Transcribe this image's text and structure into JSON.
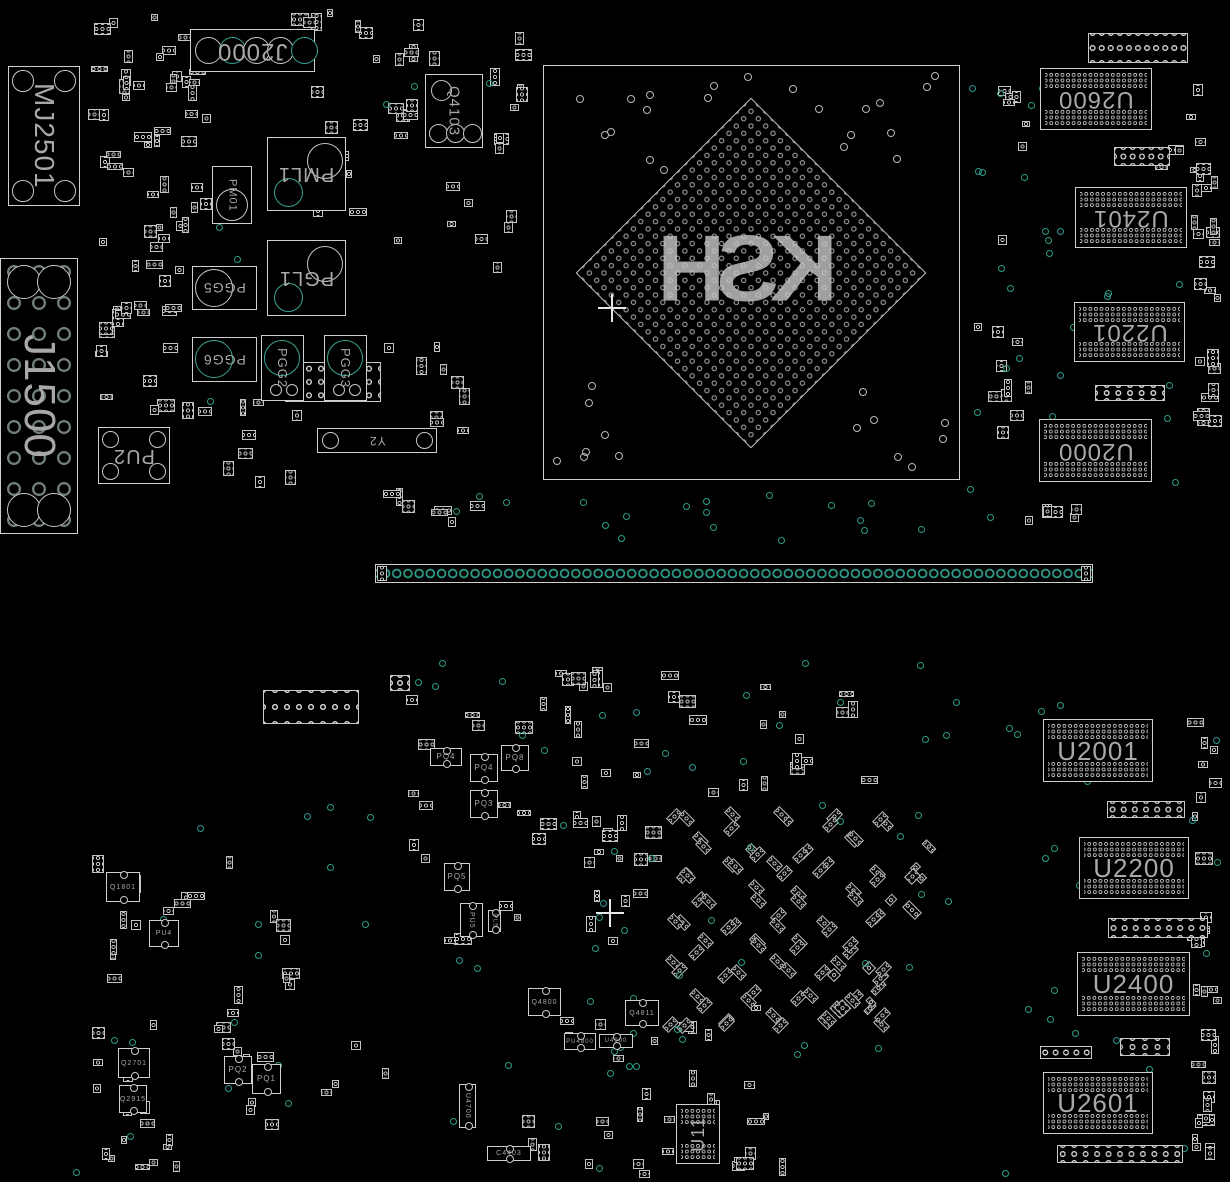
{
  "board": {
    "background": "#000000",
    "outline_color": "#cfcfcf",
    "accent_teal": "#2f9c8a",
    "text_color": "#a8a8a8"
  },
  "bga": {
    "label": "KSH",
    "x": 543,
    "y": 65,
    "w": 415,
    "h": 413,
    "cx": 750,
    "cy": 272,
    "side": 248
  },
  "slot": {
    "x": 375,
    "y": 564,
    "w": 718,
    "h": 19
  },
  "components": [
    {
      "label": "MJ2501",
      "x": 8,
      "y": 66,
      "w": 72,
      "h": 140,
      "type": "mech",
      "rot": "v",
      "fs": 28
    },
    {
      "label": "J1500",
      "x": 0,
      "y": 258,
      "w": 78,
      "h": 276,
      "type": "bigconn",
      "rot": "v",
      "fs": 44
    },
    {
      "label": "J2000",
      "x": 190,
      "y": 29,
      "w": 125,
      "h": 43,
      "type": "jconn",
      "rot": "r180",
      "fs": 24
    },
    {
      "label": "Q4103",
      "x": 425,
      "y": 74,
      "w": 58,
      "h": 74,
      "type": "qbox",
      "rot": "v",
      "fs": 15
    },
    {
      "label": "PM01",
      "x": 212,
      "y": 166,
      "w": 40,
      "h": 58,
      "type": "circ-b",
      "rot": "v",
      "fs": 11
    },
    {
      "label": "PML1",
      "x": 267,
      "y": 137,
      "w": 79,
      "h": 74,
      "type": "pgbox",
      "rot": "r180",
      "fs": 20
    },
    {
      "label": "PGL1",
      "x": 267,
      "y": 240,
      "w": 79,
      "h": 76,
      "type": "pgbox",
      "rot": "r180",
      "fs": 20
    },
    {
      "label": "PGG5",
      "x": 192,
      "y": 266,
      "w": 65,
      "h": 44,
      "type": "circ-l",
      "rot": "r180",
      "fs": 14
    },
    {
      "label": "PGG6",
      "x": 192,
      "y": 337,
      "w": 65,
      "h": 45,
      "type": "circ-l",
      "rot": "r180",
      "fs": 14
    },
    {
      "label": "PGG2",
      "x": 261,
      "y": 335,
      "w": 43,
      "h": 66,
      "type": "circ-t",
      "rot": "v",
      "fs": 13
    },
    {
      "label": "PGG3",
      "x": 324,
      "y": 335,
      "w": 43,
      "h": 66,
      "type": "circ-t",
      "rot": "v",
      "fs": 13
    },
    {
      "label": "PU2",
      "x": 98,
      "y": 427,
      "w": 72,
      "h": 57,
      "type": "mech",
      "rot": "r180",
      "fs": 20
    },
    {
      "label": "Y2",
      "x": 317,
      "y": 428,
      "w": 120,
      "h": 25,
      "type": "osc",
      "rot": "r180",
      "fs": 12
    },
    {
      "label": "U2600",
      "x": 1040,
      "y": 68,
      "w": 112,
      "h": 62,
      "type": "ic",
      "rot": "r180",
      "fs": 24
    },
    {
      "label": "U2401",
      "x": 1075,
      "y": 187,
      "w": 112,
      "h": 61,
      "type": "ic",
      "rot": "r180",
      "fs": 24
    },
    {
      "label": "U2201",
      "x": 1074,
      "y": 302,
      "w": 111,
      "h": 60,
      "type": "ic",
      "rot": "r180",
      "fs": 24
    },
    {
      "label": "U2000",
      "x": 1039,
      "y": 419,
      "w": 113,
      "h": 63,
      "type": "ic",
      "rot": "r180",
      "fs": 24
    },
    {
      "label": "U2001",
      "x": 1043,
      "y": 719,
      "w": 110,
      "h": 63,
      "type": "ic",
      "rot": "r0",
      "fs": 26
    },
    {
      "label": "U2200",
      "x": 1079,
      "y": 837,
      "w": 110,
      "h": 62,
      "type": "ic",
      "rot": "r0",
      "fs": 26
    },
    {
      "label": "U2400",
      "x": 1077,
      "y": 952,
      "w": 113,
      "h": 64,
      "type": "ic",
      "rot": "r0",
      "fs": 26
    },
    {
      "label": "U2601",
      "x": 1043,
      "y": 1072,
      "w": 110,
      "h": 62,
      "type": "ic",
      "rot": "r0",
      "fs": 26
    },
    {
      "label": "U11",
      "x": 676,
      "y": 1104,
      "w": 44,
      "h": 60,
      "type": "ic-v",
      "rot": "v2",
      "fs": 18
    },
    {
      "label": "Q1801",
      "x": 106,
      "y": 872,
      "w": 34,
      "h": 30,
      "type": "small",
      "rot": "r0",
      "fs": 7
    },
    {
      "label": "PU4",
      "x": 149,
      "y": 920,
      "w": 30,
      "h": 27,
      "type": "small",
      "rot": "r0",
      "fs": 7
    },
    {
      "label": "Q2701",
      "x": 118,
      "y": 1048,
      "w": 32,
      "h": 30,
      "type": "small",
      "rot": "r0",
      "fs": 7
    },
    {
      "label": "Q2915",
      "x": 119,
      "y": 1085,
      "w": 28,
      "h": 28,
      "type": "small",
      "rot": "r0",
      "fs": 7
    },
    {
      "label": "PQ2",
      "x": 224,
      "y": 1056,
      "w": 28,
      "h": 28,
      "type": "small",
      "rot": "r0",
      "fs": 8
    },
    {
      "label": "PQ1",
      "x": 252,
      "y": 1064,
      "w": 29,
      "h": 30,
      "type": "small",
      "rot": "r0",
      "fs": 8
    },
    {
      "label": "PQ4",
      "x": 430,
      "y": 748,
      "w": 32,
      "h": 18,
      "type": "small",
      "rot": "r0",
      "fs": 8
    },
    {
      "label": "PQ4",
      "x": 470,
      "y": 754,
      "w": 28,
      "h": 28,
      "type": "small",
      "rot": "r0",
      "fs": 8
    },
    {
      "label": "PQ8",
      "x": 501,
      "y": 745,
      "w": 28,
      "h": 26,
      "type": "small",
      "rot": "r0",
      "fs": 8
    },
    {
      "label": "PQ3",
      "x": 470,
      "y": 790,
      "w": 28,
      "h": 28,
      "type": "small",
      "rot": "r0",
      "fs": 8
    },
    {
      "label": "PQ5",
      "x": 444,
      "y": 863,
      "w": 26,
      "h": 28,
      "type": "small",
      "rot": "r0",
      "fs": 8
    },
    {
      "label": "PU5",
      "x": 460,
      "y": 903,
      "w": 23,
      "h": 34,
      "type": "small",
      "rot": "v",
      "fs": 7
    },
    {
      "label": "PL5",
      "x": 488,
      "y": 910,
      "w": 13,
      "h": 22,
      "type": "small",
      "rot": "v",
      "fs": 6
    },
    {
      "label": "Q4800",
      "x": 528,
      "y": 988,
      "w": 33,
      "h": 28,
      "type": "small",
      "rot": "r0",
      "fs": 7
    },
    {
      "label": "Q4811",
      "x": 625,
      "y": 1000,
      "w": 34,
      "h": 26,
      "type": "small",
      "rot": "r0",
      "fs": 7
    },
    {
      "label": "PU4800",
      "x": 564,
      "y": 1033,
      "w": 32,
      "h": 17,
      "type": "small",
      "rot": "r0",
      "fs": 6
    },
    {
      "label": "U4900",
      "x": 599,
      "y": 1034,
      "w": 34,
      "h": 14,
      "type": "small",
      "rot": "r0",
      "fs": 6
    },
    {
      "label": "U4700",
      "x": 459,
      "y": 1084,
      "w": 17,
      "h": 44,
      "type": "small",
      "rot": "v",
      "fs": 7
    },
    {
      "label": "C4403",
      "x": 487,
      "y": 1146,
      "w": 44,
      "h": 15,
      "type": "small",
      "rot": "r0",
      "fs": 7
    }
  ]
}
